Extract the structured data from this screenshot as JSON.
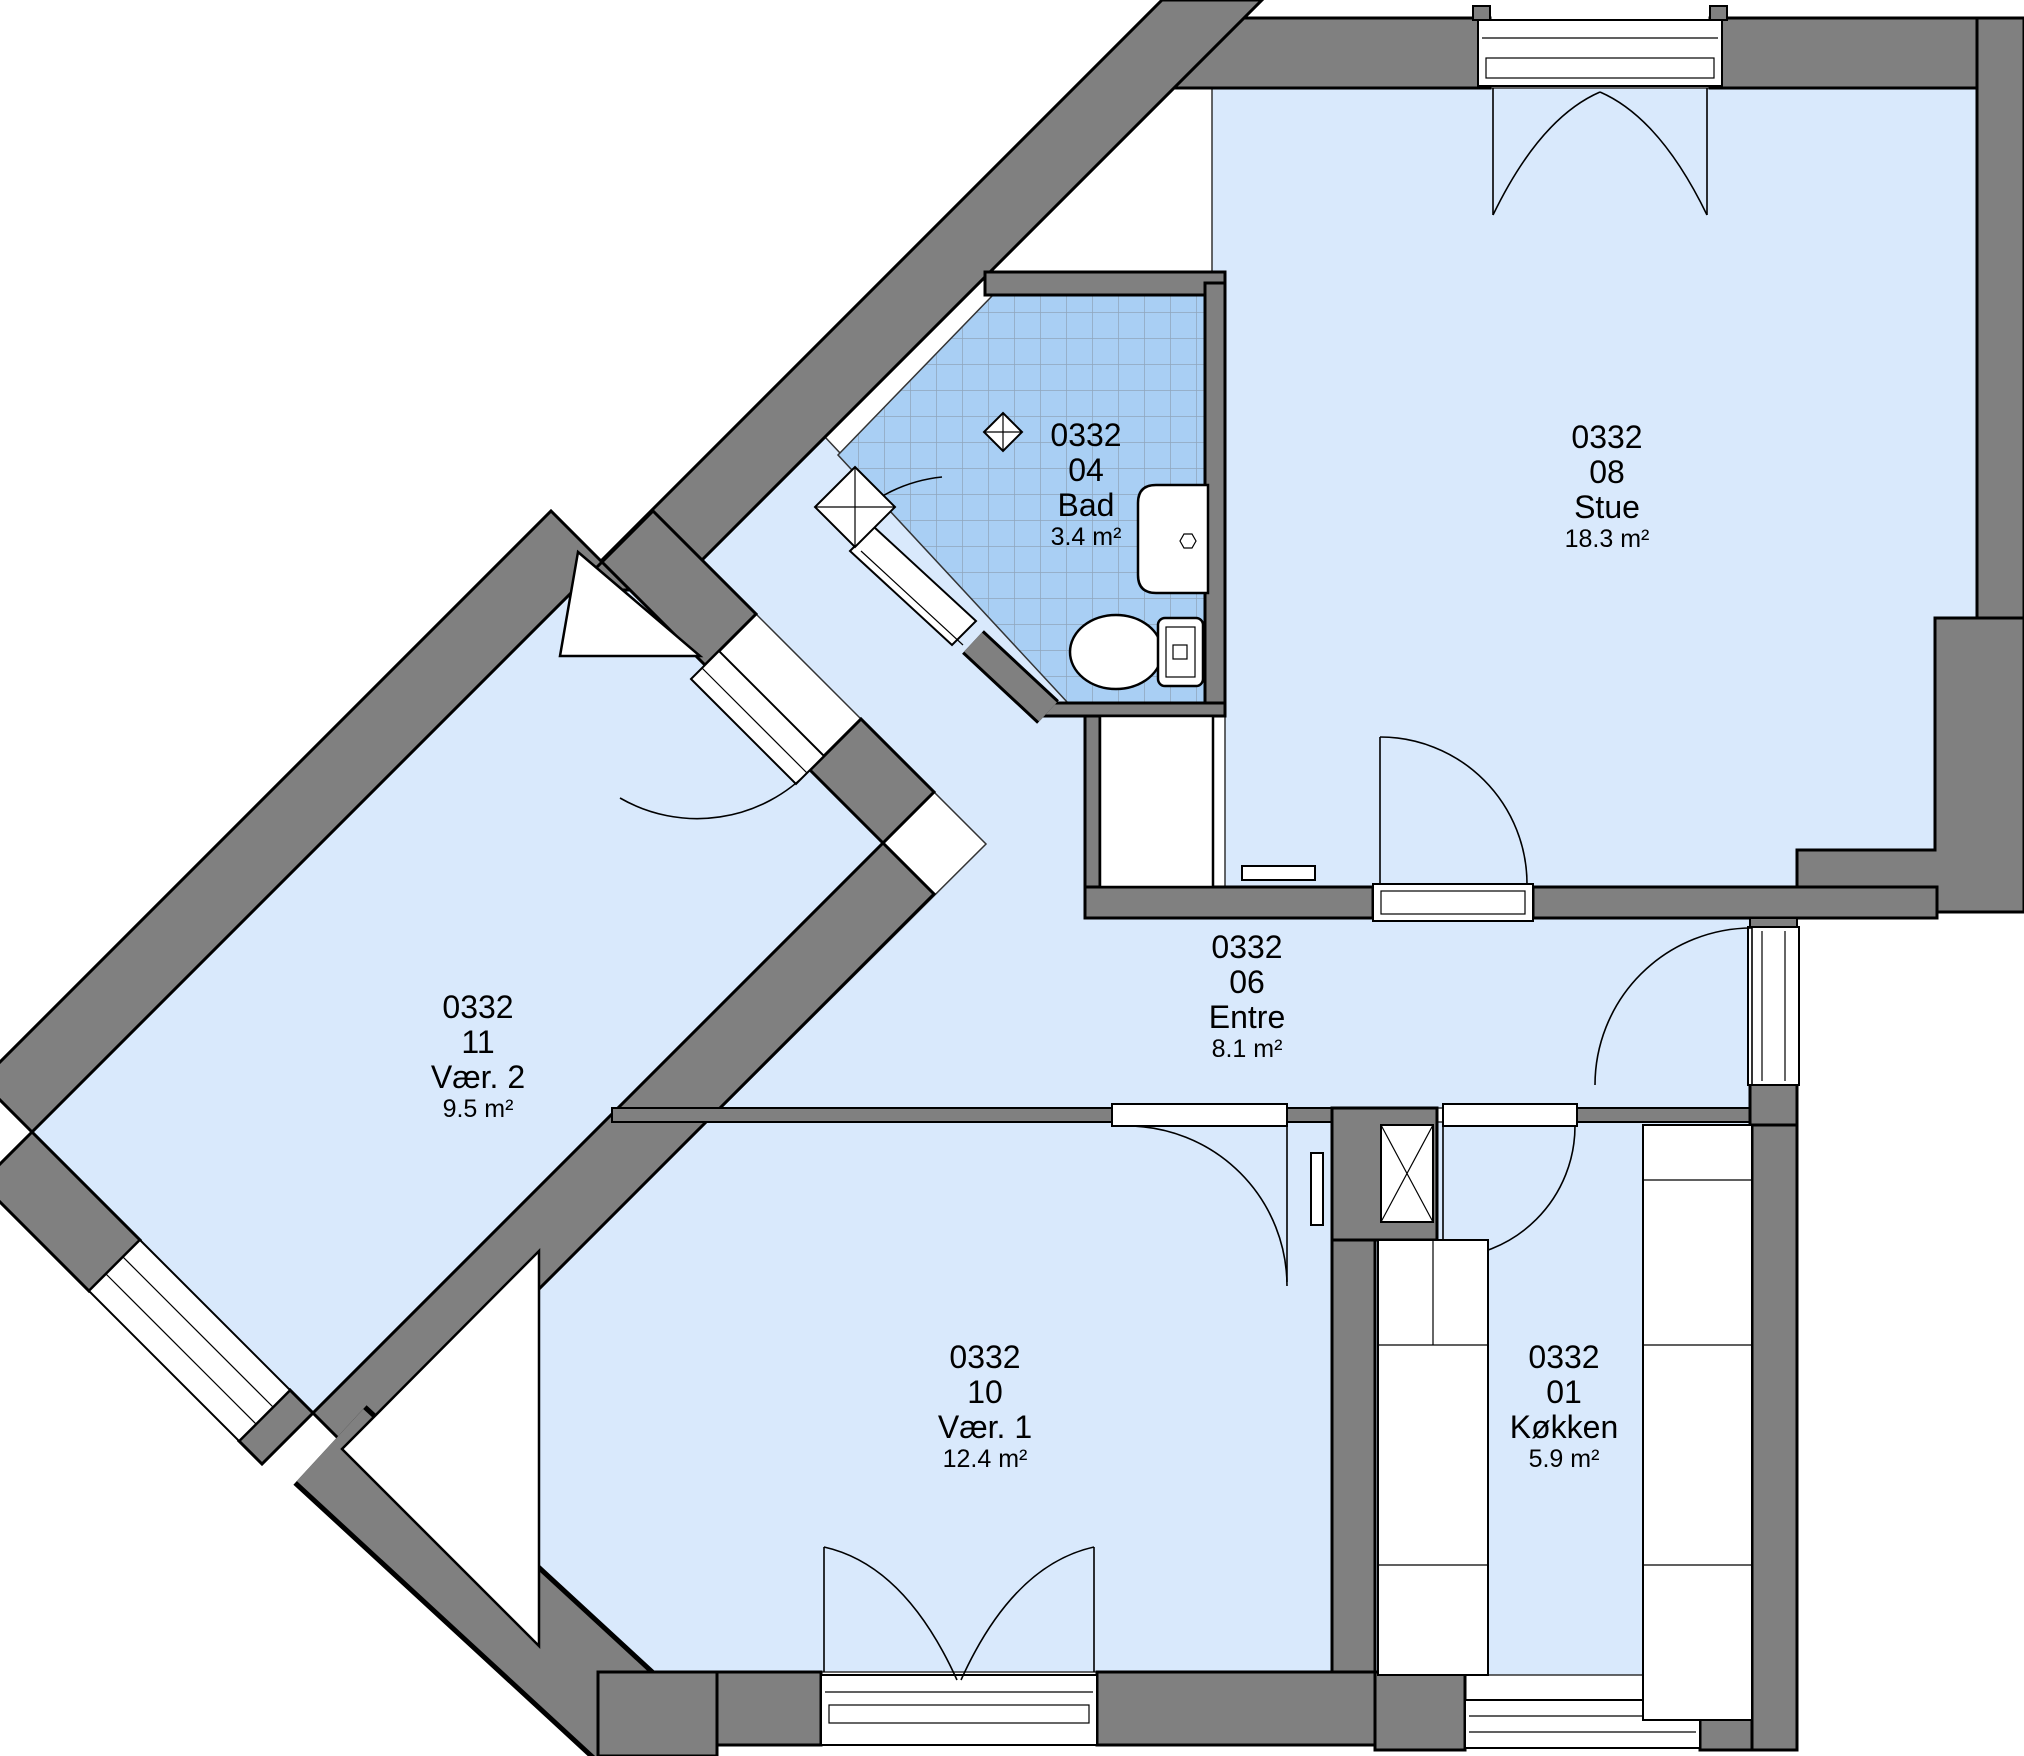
{
  "plan": {
    "colors": {
      "wall": "#808080",
      "room_fill": "#D9E9FC",
      "bath_fill": "#A9CFF4",
      "tile_line": "#8FA6BC",
      "outline": "#000000"
    },
    "rooms": [
      {
        "key": "bad",
        "unit": "0332",
        "number": "04",
        "name": "Bad",
        "area": "3.4 m²"
      },
      {
        "key": "stue",
        "unit": "0332",
        "number": "08",
        "name": "Stue",
        "area": "18.3 m²"
      },
      {
        "key": "entre",
        "unit": "0332",
        "number": "06",
        "name": "Entre",
        "area": "8.1 m²"
      },
      {
        "key": "vaer2",
        "unit": "0332",
        "number": "11",
        "name": "Vær. 2",
        "area": "9.5 m²"
      },
      {
        "key": "vaer1",
        "unit": "0332",
        "number": "10",
        "name": "Vær. 1",
        "area": "12.4 m²"
      },
      {
        "key": "koekken",
        "unit": "0332",
        "number": "01",
        "name": "Køkken",
        "area": "5.9 m²"
      }
    ]
  }
}
